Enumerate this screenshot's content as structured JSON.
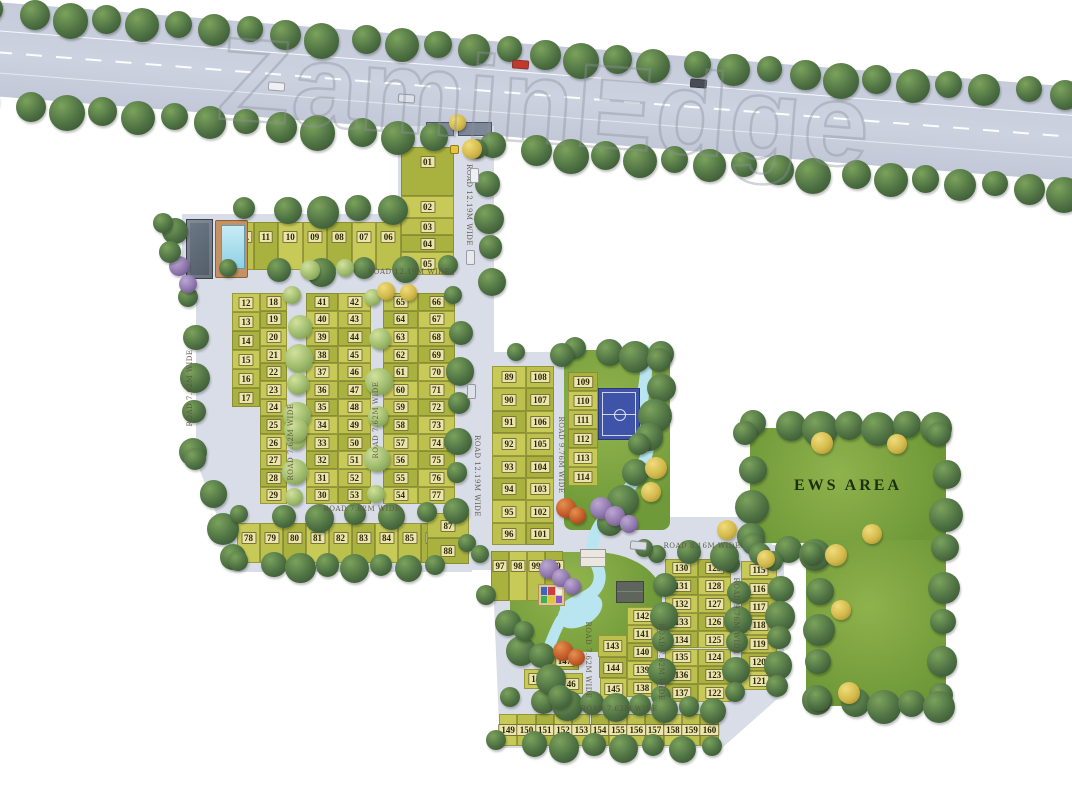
{
  "watermark": "ZaminEdge",
  "areas": {
    "ews": "EWS AREA"
  },
  "roads": {
    "entry_top": "ROAD 12.19M WIDE",
    "row_top": "ROAD 12.19M WIDE",
    "left_vert": "ROAD 7.62M WIDE",
    "mid_vert_a": "ROAD 7.62M WIDE",
    "mid_vert_b": "ROAD 7.62M WIDE",
    "entry_mid": "ROAD 12.19M WIDE",
    "vert_976": "ROAD 9.76M WIDE",
    "mid_horiz": "ROAD 7.62M WIDE",
    "east_horiz": "ROAD 8.16M WIDE",
    "south_vert_a": "ROAD 7.62M WIDE",
    "south_vert_b": "ROAD 7.62M WIDE",
    "south_vert_976": "ROAD 9.76M WIDE",
    "south_horiz": "ROAD 7.62M WIDE"
  },
  "plot_clusters": {
    "gate_row": [
      "10A",
      "11",
      "10",
      "09",
      "08",
      "07",
      "06"
    ],
    "entry_col": [
      "01",
      "02",
      "03",
      "04",
      "05"
    ],
    "col_12_17": [
      "12",
      "13",
      "14",
      "15",
      "16",
      "17"
    ],
    "col_18_29": [
      "18",
      "19",
      "20",
      "21",
      "22",
      "23",
      "24",
      "25",
      "26",
      "27",
      "28",
      "29"
    ],
    "col_41_30": [
      "41",
      "40",
      "39",
      "38",
      "37",
      "36",
      "35",
      "34",
      "33",
      "32",
      "31",
      "30"
    ],
    "col_42_53": [
      "42",
      "43",
      "44",
      "45",
      "46",
      "47",
      "48",
      "49",
      "50",
      "51",
      "52",
      "53"
    ],
    "col_65_54": [
      "65",
      "64",
      "63",
      "62",
      "61",
      "60",
      "59",
      "58",
      "57",
      "56",
      "55",
      "54"
    ],
    "col_66_77": [
      "66",
      "67",
      "68",
      "69",
      "70",
      "71",
      "72",
      "73",
      "74",
      "75",
      "76",
      "77"
    ],
    "row_78_86": [
      "78",
      "79",
      "80",
      "81",
      "82",
      "83",
      "84",
      "85",
      "86"
    ],
    "col_87_88": [
      "87",
      "88"
    ],
    "col_89_96": [
      "89",
      "90",
      "91",
      "92",
      "93",
      "94",
      "95",
      "96"
    ],
    "row_97_100": [
      "97",
      "98",
      "99",
      "100"
    ],
    "col_108_101": [
      "108",
      "107",
      "106",
      "105",
      "104",
      "103",
      "102",
      "101"
    ],
    "col_109_114": [
      "109",
      "110",
      "111",
      "112",
      "113",
      "114"
    ],
    "col_115_121": [
      "115",
      "116",
      "117",
      "118",
      "119",
      "120",
      "121"
    ],
    "col_130_137": [
      "130",
      "131",
      "132",
      "133",
      "134",
      "135",
      "136",
      "137"
    ],
    "col_129_122": [
      "129",
      "128",
      "127",
      "126",
      "125",
      "124",
      "123",
      "122"
    ],
    "col_142_138": [
      "142",
      "141",
      "140",
      "139",
      "138"
    ],
    "col_143_145": [
      "143",
      "144",
      "145"
    ],
    "grp_146_148": [
      "147",
      "148",
      "146"
    ],
    "row_149_160": [
      "149",
      "150",
      "151",
      "152",
      "153",
      "154",
      "155",
      "156",
      "157",
      "158",
      "159",
      "160"
    ]
  }
}
